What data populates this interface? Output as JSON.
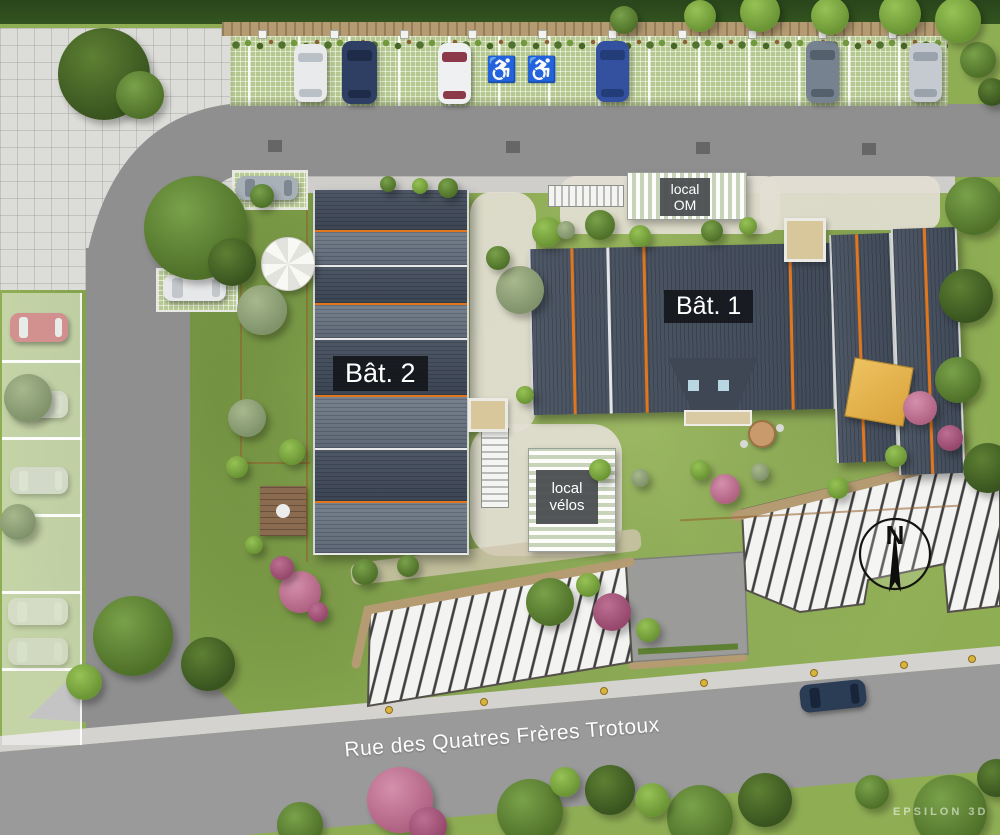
{
  "scene": {
    "type": "architectural-site-plan",
    "street_label": "Rue des Quatres Frères Trotoux",
    "watermark": "EPSILON 3D",
    "compass_label": "N",
    "accessible_icon": "♿",
    "buildings": {
      "bat1": {
        "label": "Bât. 1"
      },
      "bat2": {
        "label": "Bât. 2"
      }
    },
    "annexes": {
      "om": {
        "line1": "local",
        "line2": "OM"
      },
      "velos": {
        "line1": "local",
        "line2": "vélos"
      }
    }
  },
  "colors": {
    "lawn": "#8fae54",
    "road": "#8f8f90",
    "plaza": "#dcdcd9",
    "paver_green": "#b5c88f",
    "roof_dark": "#424b57",
    "roof_light": "#6e7987",
    "accent_orange": "#e2761d",
    "hatch_bg": "#f3f3f1",
    "hatch_line": "#3f3f3f",
    "stone_wall": "#b49b72",
    "badge_dark": "#1d2125",
    "badge_gray": "#55585a",
    "path_light": "#e3ded2",
    "sidewalk": "#cfcecb"
  },
  "bat2_sections": [
    {
      "h": 40,
      "tone": "dark",
      "sep": "o"
    },
    {
      "h": 33,
      "tone": "light",
      "sep": "w"
    },
    {
      "h": 36,
      "tone": "dark",
      "sep": "o"
    },
    {
      "h": 33,
      "tone": "light",
      "sep": "w"
    },
    {
      "h": 55,
      "tone": "dark",
      "sep": "o"
    },
    {
      "h": 51,
      "tone": "light",
      "sep": "w"
    },
    {
      "h": 51,
      "tone": "dark",
      "sep": "o"
    },
    {
      "h": 50,
      "tone": "light",
      "sep": "none"
    }
  ],
  "cars": [
    {
      "name": "car-white",
      "orient": "v",
      "x": 294,
      "y": 44,
      "w": 33,
      "h": 58,
      "rot": 0,
      "body": "#e8eaec",
      "glass": "#b9c0c6",
      "o": 1
    },
    {
      "name": "van-navy",
      "orient": "v",
      "x": 342,
      "y": 41,
      "w": 35,
      "h": 63,
      "rot": 0,
      "body": "#2e3f63",
      "glass": "#1f2c49",
      "o": 1
    },
    {
      "name": "car-white-red",
      "orient": "v",
      "x": 438,
      "y": 43,
      "w": 33,
      "h": 61,
      "rot": 0,
      "body": "#eef0f1",
      "glass": "#8c3a4a",
      "o": 1
    },
    {
      "name": "car-blue",
      "orient": "v",
      "x": 596,
      "y": 41,
      "w": 33,
      "h": 61,
      "rot": 0,
      "body": "#33519e",
      "glass": "#223d77",
      "o": 1
    },
    {
      "name": "car-gray",
      "orient": "v",
      "x": 806,
      "y": 41,
      "w": 33,
      "h": 62,
      "rot": 0,
      "body": "#76828f",
      "glass": "#55606d",
      "o": 1
    },
    {
      "name": "car-silver",
      "orient": "v",
      "x": 909,
      "y": 43,
      "w": 33,
      "h": 59,
      "rot": 0,
      "body": "#c5cad1",
      "glass": "#9aa2ab",
      "o": 1
    },
    {
      "name": "car-gray-2",
      "orient": "h",
      "x": 236,
      "y": 176,
      "w": 62,
      "h": 24,
      "rot": 0,
      "body": "#a8b0b8",
      "glass": "#7d8791",
      "o": 1
    },
    {
      "name": "van-white",
      "orient": "h",
      "x": 163,
      "y": 275,
      "w": 63,
      "h": 26,
      "rot": 0,
      "body": "#e7e8e9",
      "glass": "#c3c7ca",
      "o": 1
    },
    {
      "name": "car-red-faded",
      "orient": "h",
      "x": 10,
      "y": 313,
      "w": 58,
      "h": 29,
      "rot": 0,
      "body": "#d4898d",
      "glass": "#edeff0",
      "o": 0.9
    },
    {
      "name": "car-faded-1",
      "orient": "h",
      "x": 10,
      "y": 391,
      "w": 58,
      "h": 27,
      "rot": 0,
      "body": "#e3e3e3",
      "glass": "#f1f1f1",
      "o": 0.55
    },
    {
      "name": "car-faded-2",
      "orient": "h",
      "x": 10,
      "y": 467,
      "w": 58,
      "h": 27,
      "rot": 0,
      "body": "#dfdfdf",
      "glass": "#efefef",
      "o": 0.6
    },
    {
      "name": "car-faded-3",
      "orient": "h",
      "x": 8,
      "y": 598,
      "w": 60,
      "h": 27,
      "rot": 0,
      "body": "#e6e6e6",
      "glass": "#f3f3f3",
      "o": 0.5
    },
    {
      "name": "car-faded-4",
      "orient": "h",
      "x": 8,
      "y": 638,
      "w": 60,
      "h": 27,
      "rot": 0,
      "body": "#e2e2e2",
      "glass": "#f0f0f0",
      "o": 0.45
    },
    {
      "name": "car-street-navy",
      "orient": "h",
      "x": 800,
      "y": 682,
      "w": 66,
      "h": 28,
      "rot": -6,
      "body": "#2b3c55",
      "glass": "#17243a",
      "o": 1
    }
  ],
  "veg_palette": {
    "g1": [
      "#79a14a",
      "#4e7028"
    ],
    "g2": [
      "#5d8033",
      "#39541f"
    ],
    "g3": [
      "#96c255",
      "#6a9434"
    ],
    "g4": [
      "#a8b88d",
      "#7f926a"
    ],
    "p1": [
      "#d490ab",
      "#b06182"
    ],
    "p2": [
      "#bd6f93",
      "#94476b"
    ]
  },
  "vegetation": [
    {
      "x": 104,
      "y": 74,
      "r": 46,
      "k": "g2"
    },
    {
      "x": 140,
      "y": 95,
      "r": 24,
      "k": "g1"
    },
    {
      "x": 196,
      "y": 228,
      "r": 52,
      "k": "g1"
    },
    {
      "x": 232,
      "y": 262,
      "r": 24,
      "k": "g2"
    },
    {
      "x": 262,
      "y": 310,
      "r": 25,
      "k": "g4"
    },
    {
      "x": 247,
      "y": 418,
      "r": 19,
      "k": "g4"
    },
    {
      "x": 292,
      "y": 452,
      "r": 13,
      "k": "g3"
    },
    {
      "x": 237,
      "y": 467,
      "r": 11,
      "k": "g3"
    },
    {
      "x": 520,
      "y": 290,
      "r": 24,
      "k": "g4"
    },
    {
      "x": 547,
      "y": 232,
      "r": 15,
      "k": "g3"
    },
    {
      "x": 498,
      "y": 258,
      "r": 12,
      "k": "g1"
    },
    {
      "x": 300,
      "y": 592,
      "r": 21,
      "k": "p1"
    },
    {
      "x": 282,
      "y": 568,
      "r": 12,
      "k": "p2"
    },
    {
      "x": 318,
      "y": 612,
      "r": 10,
      "k": "p2"
    },
    {
      "x": 365,
      "y": 572,
      "r": 13,
      "k": "g1"
    },
    {
      "x": 408,
      "y": 566,
      "r": 11,
      "k": "g1"
    },
    {
      "x": 550,
      "y": 602,
      "r": 24,
      "k": "g1"
    },
    {
      "x": 588,
      "y": 585,
      "r": 12,
      "k": "g3"
    },
    {
      "x": 612,
      "y": 612,
      "r": 19,
      "k": "p2"
    },
    {
      "x": 648,
      "y": 630,
      "r": 12,
      "k": "g3"
    },
    {
      "x": 725,
      "y": 489,
      "r": 15,
      "k": "p1"
    },
    {
      "x": 700,
      "y": 470,
      "r": 10,
      "k": "g3"
    },
    {
      "x": 760,
      "y": 472,
      "r": 9,
      "k": "g4"
    },
    {
      "x": 920,
      "y": 408,
      "r": 17,
      "k": "p1"
    },
    {
      "x": 950,
      "y": 438,
      "r": 13,
      "k": "p2"
    },
    {
      "x": 896,
      "y": 456,
      "r": 11,
      "k": "g3"
    },
    {
      "x": 974,
      "y": 206,
      "r": 29,
      "k": "g1"
    },
    {
      "x": 966,
      "y": 296,
      "r": 27,
      "k": "g2"
    },
    {
      "x": 958,
      "y": 380,
      "r": 23,
      "k": "g1"
    },
    {
      "x": 988,
      "y": 468,
      "r": 25,
      "k": "g2"
    },
    {
      "x": 978,
      "y": 60,
      "r": 18,
      "k": "g1"
    },
    {
      "x": 992,
      "y": 92,
      "r": 14,
      "k": "g2"
    },
    {
      "x": 700,
      "y": 16,
      "r": 16,
      "k": "g3"
    },
    {
      "x": 760,
      "y": 12,
      "r": 20,
      "k": "g3"
    },
    {
      "x": 830,
      "y": 16,
      "r": 19,
      "k": "g3"
    },
    {
      "x": 900,
      "y": 14,
      "r": 21,
      "k": "g3"
    },
    {
      "x": 958,
      "y": 20,
      "r": 23,
      "k": "g3"
    },
    {
      "x": 624,
      "y": 20,
      "r": 14,
      "k": "g1"
    },
    {
      "x": 133,
      "y": 636,
      "r": 40,
      "k": "g1"
    },
    {
      "x": 208,
      "y": 664,
      "r": 27,
      "k": "g2"
    },
    {
      "x": 84,
      "y": 682,
      "r": 18,
      "k": "g3"
    },
    {
      "x": 28,
      "y": 398,
      "r": 24,
      "k": "g4"
    },
    {
      "x": 18,
      "y": 522,
      "r": 18,
      "k": "g4"
    },
    {
      "x": 300,
      "y": 825,
      "r": 23,
      "k": "g1"
    },
    {
      "x": 400,
      "y": 800,
      "r": 33,
      "k": "p1"
    },
    {
      "x": 428,
      "y": 826,
      "r": 19,
      "k": "p2"
    },
    {
      "x": 530,
      "y": 812,
      "r": 33,
      "k": "g1"
    },
    {
      "x": 610,
      "y": 790,
      "r": 25,
      "k": "g2"
    },
    {
      "x": 700,
      "y": 818,
      "r": 33,
      "k": "g1"
    },
    {
      "x": 765,
      "y": 800,
      "r": 27,
      "k": "g2"
    },
    {
      "x": 872,
      "y": 792,
      "r": 17,
      "k": "g1"
    },
    {
      "x": 950,
      "y": 812,
      "r": 37,
      "k": "g1"
    },
    {
      "x": 996,
      "y": 778,
      "r": 19,
      "k": "g2"
    },
    {
      "x": 565,
      "y": 782,
      "r": 15,
      "k": "g3"
    },
    {
      "x": 652,
      "y": 800,
      "r": 17,
      "k": "g3"
    },
    {
      "x": 600,
      "y": 470,
      "r": 11,
      "k": "g3"
    },
    {
      "x": 640,
      "y": 478,
      "r": 9,
      "k": "g4"
    },
    {
      "x": 838,
      "y": 488,
      "r": 11,
      "k": "g3"
    },
    {
      "x": 600,
      "y": 225,
      "r": 15,
      "k": "g1"
    },
    {
      "x": 640,
      "y": 236,
      "r": 11,
      "k": "g3"
    },
    {
      "x": 566,
      "y": 230,
      "r": 9,
      "k": "g4"
    },
    {
      "x": 712,
      "y": 231,
      "r": 11,
      "k": "g1"
    },
    {
      "x": 748,
      "y": 226,
      "r": 9,
      "k": "g3"
    },
    {
      "x": 525,
      "y": 395,
      "r": 9,
      "k": "g3"
    },
    {
      "x": 254,
      "y": 545,
      "r": 9,
      "k": "g3"
    },
    {
      "x": 448,
      "y": 188,
      "r": 10,
      "k": "g1"
    },
    {
      "x": 420,
      "y": 186,
      "r": 8,
      "k": "g3"
    },
    {
      "x": 388,
      "y": 184,
      "r": 8,
      "k": "g1"
    },
    {
      "x": 262,
      "y": 196,
      "r": 12,
      "k": "g1"
    }
  ],
  "posts": [
    258,
    330,
    400,
    468,
    538,
    608,
    678,
    748,
    818,
    888
  ],
  "accessible_spots": [
    {
      "x": 486,
      "y": 56
    },
    {
      "x": 526,
      "y": 56
    }
  ],
  "drains": [
    {
      "x": 268,
      "y": 140
    },
    {
      "x": 506,
      "y": 141
    },
    {
      "x": 696,
      "y": 142
    },
    {
      "x": 862,
      "y": 143
    }
  ],
  "bollards": [
    {
      "x": 385,
      "y": 706
    },
    {
      "x": 480,
      "y": 698
    },
    {
      "x": 600,
      "y": 687
    },
    {
      "x": 700,
      "y": 679
    },
    {
      "x": 810,
      "y": 669
    },
    {
      "x": 900,
      "y": 661
    },
    {
      "x": 968,
      "y": 655
    }
  ]
}
